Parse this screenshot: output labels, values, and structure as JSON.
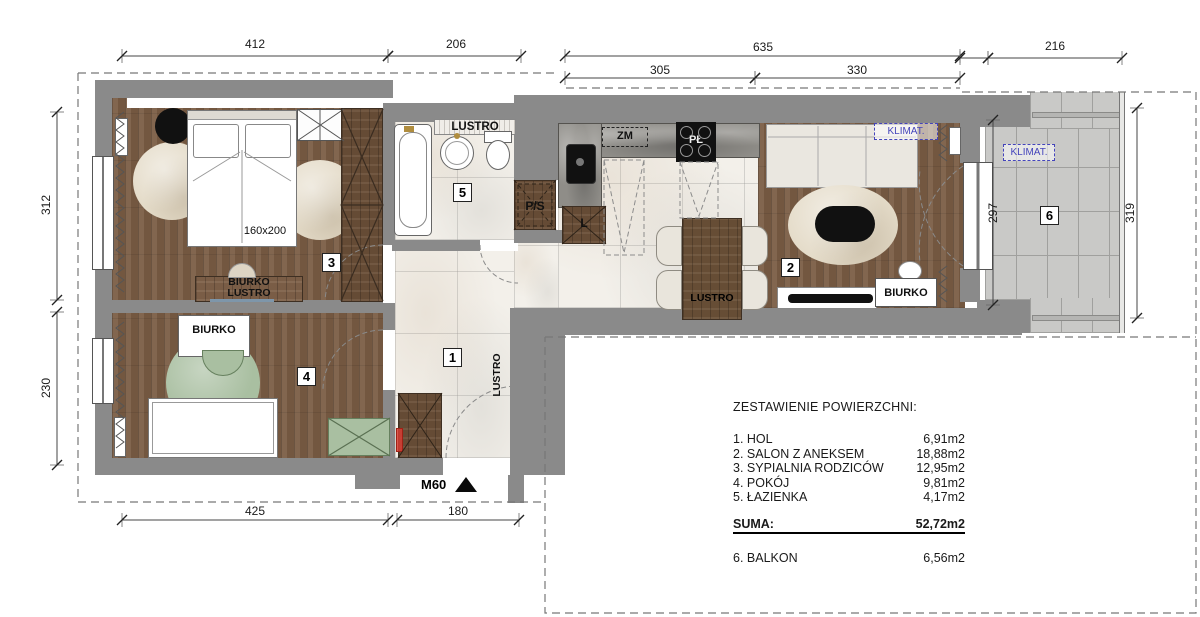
{
  "plan": {
    "rooms": {
      "hol": {
        "number": "1"
      },
      "salon": {
        "number": "2"
      },
      "sypialnia": {
        "number": "3"
      },
      "pokoj": {
        "number": "4"
      },
      "lazienka": {
        "number": "5"
      },
      "balkon": {
        "number": "6"
      }
    },
    "labels": {
      "lustro": "LUSTRO",
      "biurko": "BIURKO",
      "bed_size": "160x200",
      "ps": "P/S",
      "zm": "ZM",
      "plyta": "PŁ",
      "lodowka": "L",
      "klimat": "KLIMAT.",
      "entry_door": "M60"
    },
    "dimensions": {
      "top_sypialnia": "412",
      "top_lazienka": "206",
      "top_total": "635",
      "top_kuchnia": "305",
      "top_salon": "330",
      "top_balkon": "216",
      "left_sypialnia": "312",
      "left_pokoj": "230",
      "balkon_inner": "297",
      "balkon_outer": "319",
      "bottom_pokoj": "425",
      "bottom_wejscie": "180"
    },
    "colors": {
      "wall": "#8a8a8a",
      "wood_floor": "#7a5c44",
      "furniture_wood": "#6a4f38",
      "marble": "#f3f0ea",
      "balcony_tile": "#c9c9c7",
      "accent_green": "#a9bfa1",
      "klimat_blue": "#4444bb",
      "mirror_blue": "#7e96aa"
    }
  },
  "legend": {
    "title": "ZESTAWIENIE POWIERZCHNI:",
    "items": [
      {
        "label": "1. HOL",
        "value": "6,91m2"
      },
      {
        "label": "2. SALON Z ANEKSEM",
        "value": "18,88m2"
      },
      {
        "label": "3. SYPIALNIA RODZICÓW",
        "value": "12,95m2"
      },
      {
        "label": "4. POKÓJ",
        "value": "9,81m2"
      },
      {
        "label": "5. ŁAZIENKA",
        "value": "4,17m2"
      }
    ],
    "sum": {
      "label": "SUMA:",
      "value": "52,72m2"
    },
    "balkon": {
      "label": "6. BALKON",
      "value": "6,56m2"
    }
  }
}
